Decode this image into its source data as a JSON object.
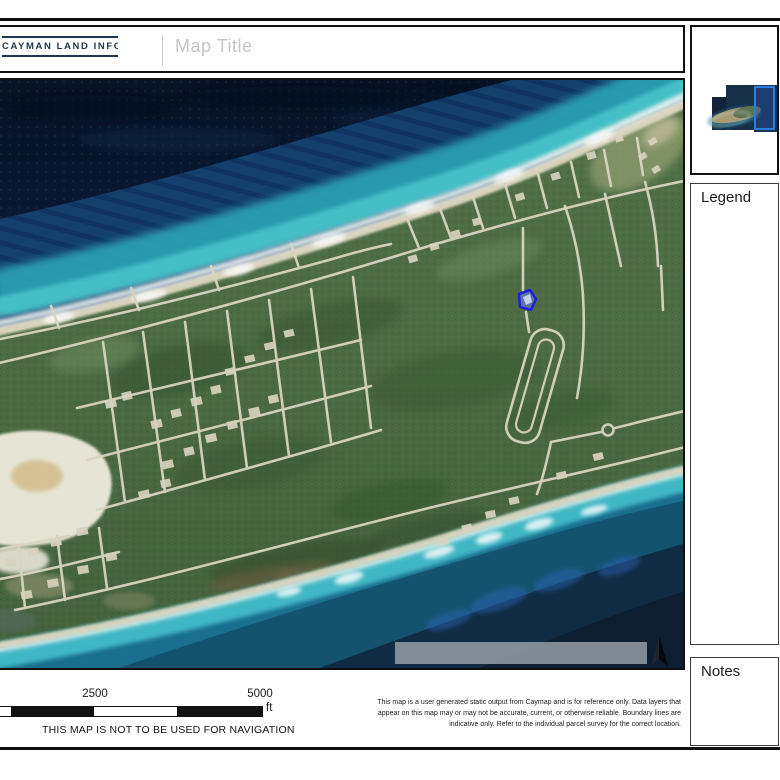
{
  "header": {
    "logo_text": "CAYMAN LAND INFO",
    "map_title_placeholder": "Map Title"
  },
  "sidebar": {
    "legend": {
      "title": "Legend"
    },
    "notes": {
      "title": "Notes"
    }
  },
  "map": {
    "selected_parcel_color": "#1c1ce6",
    "north_arrow": "north-arrow"
  },
  "footer": {
    "scale_bar": {
      "labels": [
        "2500",
        "5000"
      ],
      "unit": "ft"
    },
    "navigation_warning": "THIS MAP IS NOT TO BE USED FOR NAVIGATION",
    "disclaimer": "This map is a user generated static output from Caymap and is for reference only. Data layers that appear on this map may or may not be accurate, current, or otherwise reliable. Boundary lines are indicative only. Refer to the individual parcel survey for the correct location."
  },
  "colors": {
    "frame": "#101010",
    "logo_navy": "#223650",
    "title_gray": "#c6c6c6",
    "ocean_deep": "#0a1c38",
    "reef_turquoise": "#2b9fb2",
    "land_green": "#4e6e46",
    "road_sand": "#d9d4c1"
  }
}
